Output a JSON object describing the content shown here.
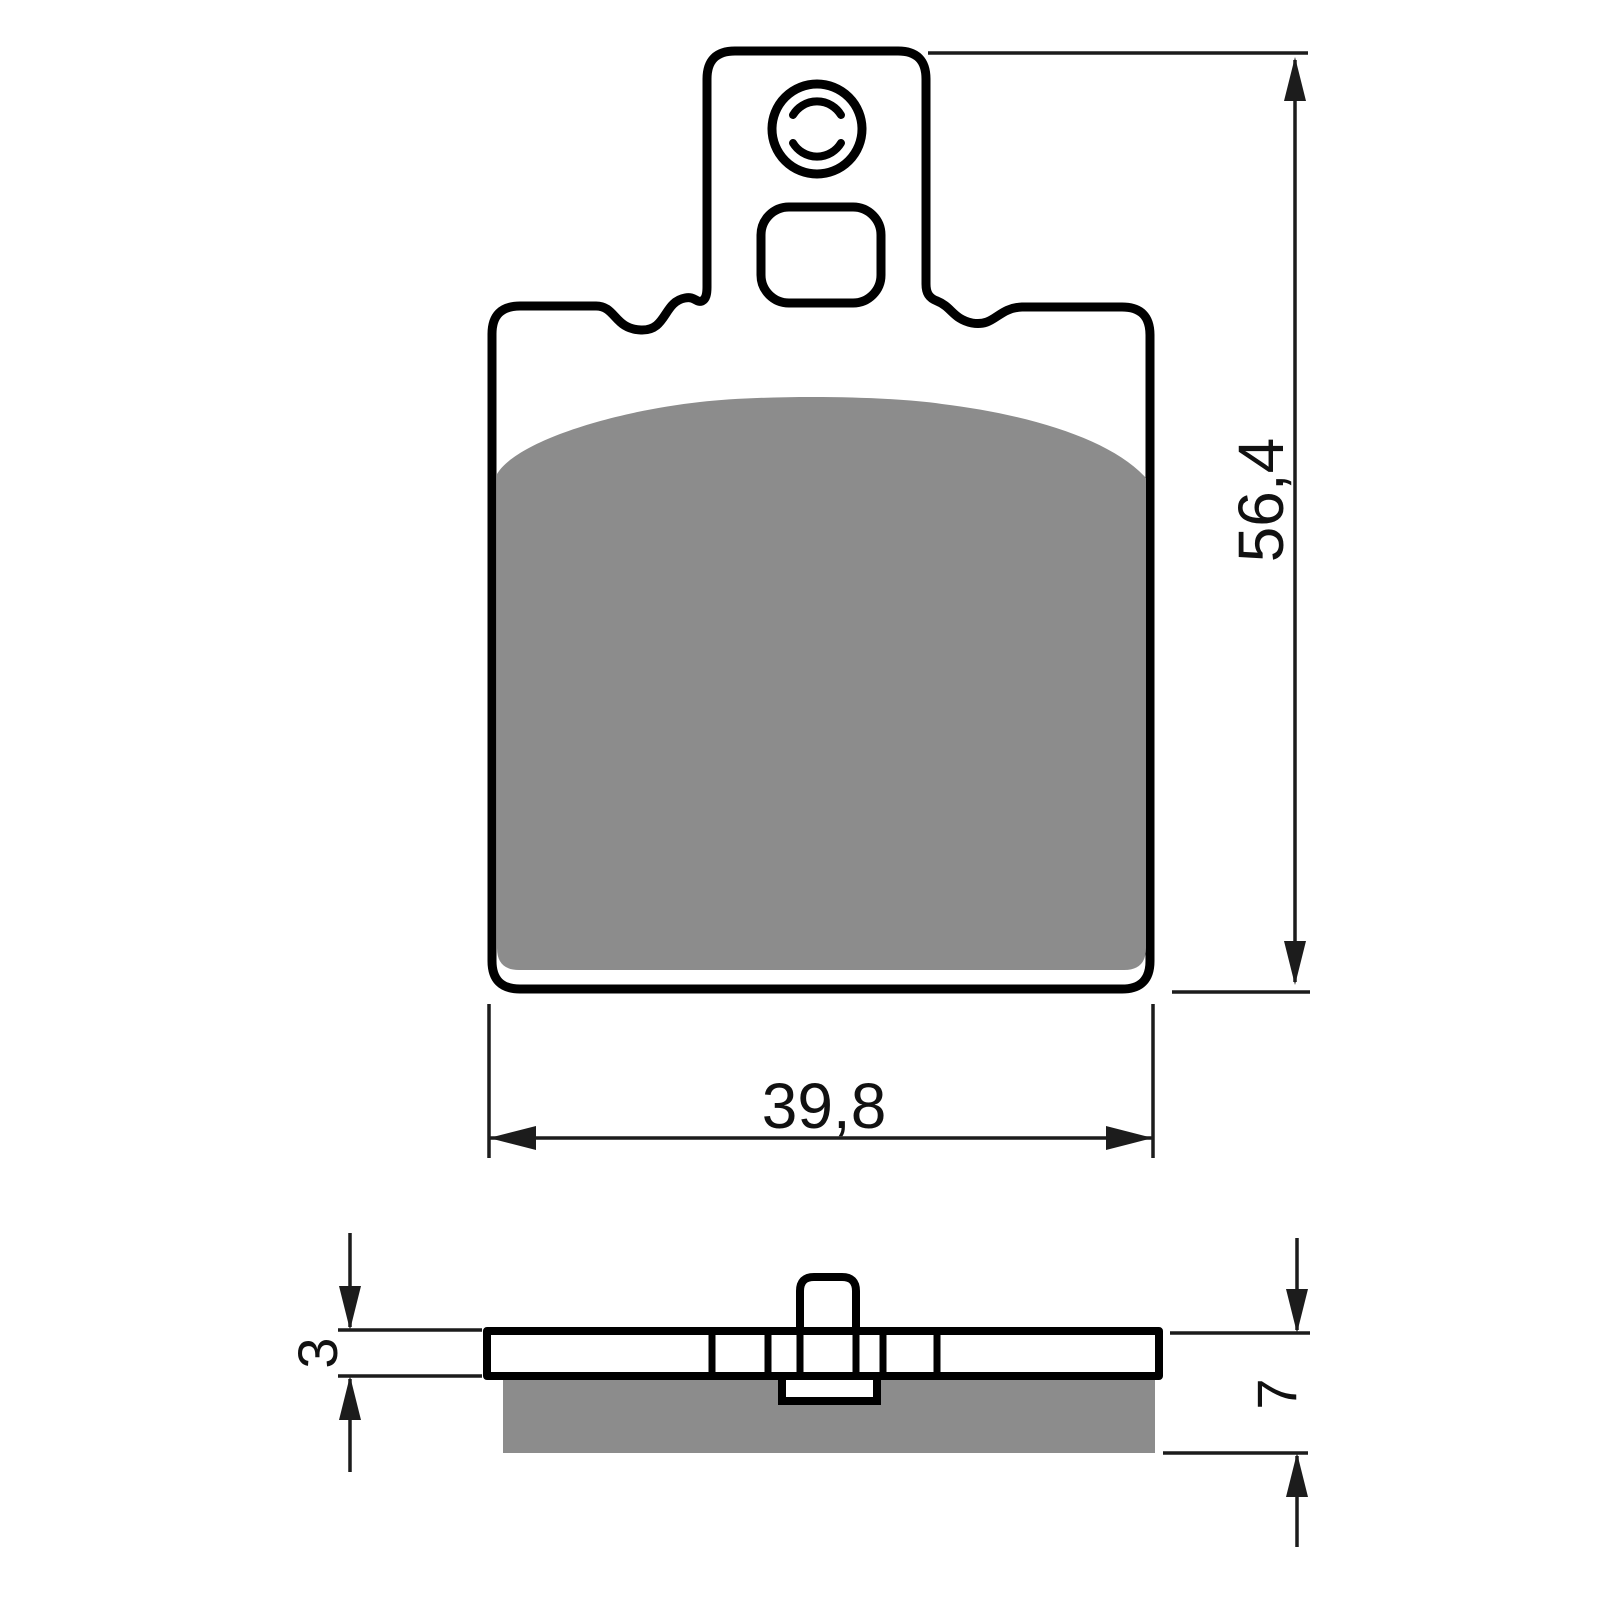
{
  "drawing": {
    "labels": {
      "height": "56,4",
      "width": "39,8",
      "backing_thickness": "3",
      "total_thickness": "7"
    },
    "colors": {
      "outline": "#000000",
      "friction_material": "#8c8c8c",
      "dimension_lines": "#1c1c1c",
      "background": "#ffffff"
    }
  }
}
